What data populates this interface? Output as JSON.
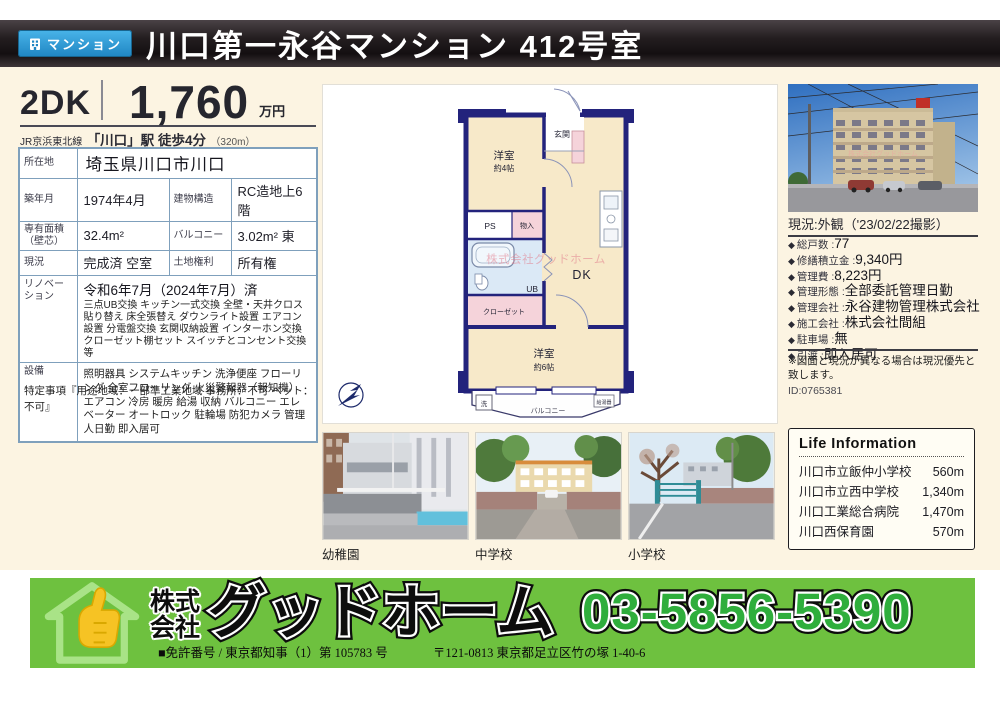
{
  "colors": {
    "badge-blue": "#2f9bd8",
    "cream": "#fcf4e2",
    "plan-navy": "#23237c",
    "footer-green": "#6ec13f",
    "phone-green": "#2fae3c"
  },
  "header": {
    "badge": "マンション",
    "title": "川口第一永谷マンション 412号室"
  },
  "price": {
    "layout": "2DK",
    "amount": "1,760",
    "unit": "万円",
    "access_line": "JR京浜東北線",
    "access_main": "「川口」駅 徒歩4分",
    "access_dist": "（320m）"
  },
  "details": {
    "rows": [
      {
        "label": "所在地",
        "value": "埼玉県川口市川口"
      },
      {
        "label": "築年月",
        "value": "1974年4月",
        "label2": "建物構造",
        "value2": "RC造地上6階"
      },
      {
        "label": "専有面積（壁芯）",
        "value": "32.4m²",
        "label2": "バルコニー",
        "value2": "3.02m² 東"
      },
      {
        "label": "現況",
        "value": "完成済 空室",
        "label2": "土地権利",
        "value2": "所有権"
      },
      {
        "label": "リノベーション",
        "title": "令和6年7月（2024年7月）済",
        "detail": "三点UB交換 キッチン一式交換 全壁・天井クロス貼り替え 床全張替え ダウンライト設置 エアコン設置 分電盤交換 玄関収納設置 インターホン交換 クローゼット棚セット スイッチとコンセント交換 等"
      },
      {
        "label": "設備",
        "value": "照明器具 システムキッチン 洗浄便座 フローリング 全室フローリング 火災警報器（報知機） エアコン 冷房 暖房 給湯 収納 バルコニー エレベーター オートロック 駐輪場 防犯カメラ 管理人日勤 即入居可"
      }
    ],
    "note": "特定事項『用途地域：一部準工業地域 事務所：不可 ペット：不可』"
  },
  "floorplan": {
    "genkan": "玄関",
    "room1_name": "洋室",
    "room1_size": "約4帖",
    "ps": "PS",
    "storage": "物入",
    "ub": "UB",
    "dk": "DK",
    "closet": "クローゼット",
    "room2_name": "洋室",
    "room2_size": "約6帖",
    "balcony": "バルコニー",
    "washer": "洗",
    "water_heater": "給湯器",
    "watermark": "株式会社グッドホーム"
  },
  "right_panel": {
    "caption": "現況:外観（'23/02/22撮影）",
    "bullet": "◆",
    "items": [
      {
        "label": "総戸数 :",
        "value": "77"
      },
      {
        "label": "修繕積立金 :",
        "value": "9,340円"
      },
      {
        "label": "管理費 :",
        "value": "8,223円"
      },
      {
        "label": "管理形態 :",
        "value": "全部委託管理日勤"
      },
      {
        "label": "管理会社 :",
        "value": "永谷建物管理株式会社"
      },
      {
        "label": "施工会社 :",
        "value": "株式会社間組"
      },
      {
        "label": "駐車場 :",
        "value": "無"
      },
      {
        "label": "引渡 :",
        "value": "即入居可"
      }
    ],
    "note": "※図面と現況が異なる場合は現況優先と致します。",
    "id": "ID:0765381"
  },
  "photos": {
    "labels": [
      "幼稚園",
      "中学校",
      "小学校"
    ]
  },
  "life_info": {
    "title": "Life Information",
    "rows": [
      {
        "name": "川口市立飯仲小学校",
        "distance": "560m"
      },
      {
        "name": "川口市立西中学校",
        "distance": "1,340m"
      },
      {
        "name": "川口工業総合病院",
        "distance": "1,470m"
      },
      {
        "name": "川口西保育園",
        "distance": "570m"
      }
    ]
  },
  "footer": {
    "company_1": "株式",
    "company_2": "会社",
    "company_name": "グッドホーム",
    "phone": "03-5856-5390",
    "license": "■免許番号 / 東京都知事（1）第 105783 号",
    "address": "〒121-0813 東京都足立区竹の塚 1-40-6"
  }
}
